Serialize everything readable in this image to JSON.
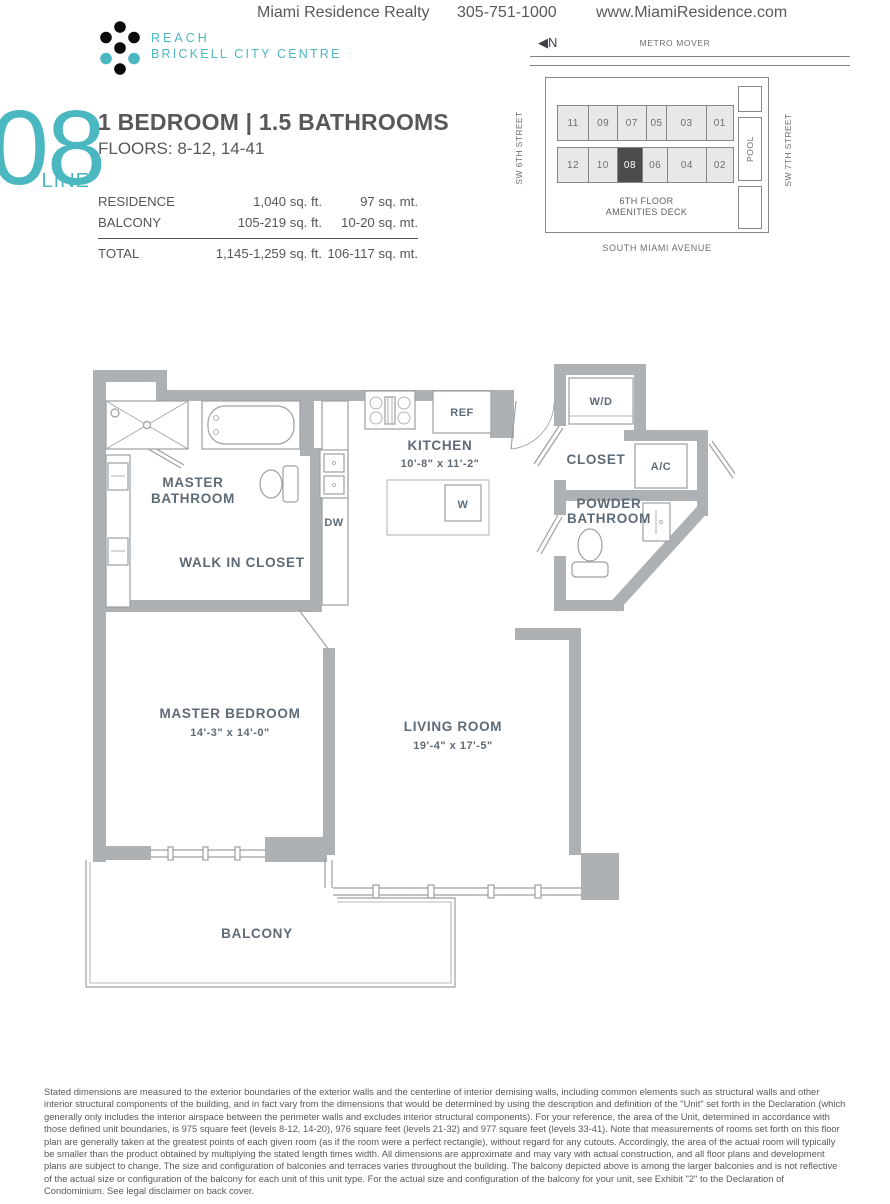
{
  "header": {
    "realty": "Miami Residence Realty",
    "phone": "305-751-1000",
    "website": "www.MiamiResidence.com"
  },
  "logo": {
    "name": "REACH",
    "subname": "BRICKELL CITY CENTRE"
  },
  "unit": {
    "line_number": "08",
    "line_label": "LINE",
    "title": "1 BEDROOM | 1.5 BATHROOMS",
    "floors": "FLOORS: 8-12, 14-41"
  },
  "area_table": {
    "rows": [
      {
        "label": "RESIDENCE",
        "sqft": "1,040 sq. ft.",
        "sqmt": "97 sq. mt."
      },
      {
        "label": "BALCONY",
        "sqft": "105-219 sq. ft.",
        "sqmt": "10-20 sq. mt."
      }
    ],
    "total": {
      "label": "TOTAL",
      "sqft": "1,145-1,259 sq. ft.",
      "sqmt": "106-117 sq. mt."
    }
  },
  "keyplan": {
    "north_label": "N",
    "metro_mover": "METRO MOVER",
    "street_left": "SW 6TH STREET",
    "street_right": "SW 7TH STREET",
    "pool": "POOL",
    "amenities_line1": "6TH  FLOOR",
    "amenities_line2": "AMENITIES DECK",
    "street_bottom": "SOUTH MIAMI AVENUE",
    "top_units": [
      "11",
      "09",
      "07",
      "05",
      "03",
      "01"
    ],
    "bottom_units": [
      "12",
      "10",
      "08",
      "06",
      "04",
      "02"
    ],
    "highlighted_unit": "08"
  },
  "floorplan": {
    "master_bathroom": {
      "line1": "MASTER",
      "line2": "BATHROOM"
    },
    "walk_in_closet": "WALK IN CLOSET",
    "kitchen": {
      "name": "KITCHEN",
      "dims": "10'-8\" x 11'-2\""
    },
    "wd": "W/D",
    "closet": "CLOSET",
    "ac": "A/C",
    "powder_bathroom": {
      "line1": "POWDER",
      "line2": "BATHROOM"
    },
    "dw": "DW",
    "ref": "REF",
    "w": "W",
    "master_bedroom": {
      "name": "MASTER BEDROOM",
      "dims": "14'-3\" x 14'-0\""
    },
    "living_room": {
      "name": "LIVING ROOM",
      "dims": "19'-4\" x 17'-5\""
    },
    "balcony": "BALCONY"
  },
  "disclaimer": "Stated dimensions are measured to the exterior boundaries of the exterior walls and the centerline of interior demising walls, including common elements such as structural walls and other interior structural components of the building, and in fact vary from the dimensions that would be determined by using the description and definition of the \"Unit\"  set forth in the Declaration (which generally only includes the interior airspace between the perimeter walls and excludes interior structural components). For your reference, the area of the Unit, determined in accordance with those defined unit boundaries, is 975 square feet (levels 8-12, 14-20), 976 square feet (levels 21-32) and 977 square feet (levels 33-41). Note that measurements of rooms set forth on this floor plan are generally taken at the greatest points of each given room (as if the room were a perfect rectangle), without regard for any cutouts. Accordingly, the area of the actual room will typically be smaller than the product obtained by multiplying the stated length times width. All dimensions are approximate and may vary with actual construction, and all floor plans and development plans are subject to change. The size and configuration of balconies and terraces varies throughout the building.  The balcony depicted above is among the larger balconies and is not reflective of the actual size or configuration of the balcony for each unit of this unit type. For the actual size and configuration of the balcony for your unit, see Exhibit \"2\" to the Declaration of Condominium. See legal disclaimer on back cover.",
  "colors": {
    "teal": "#4bb8c1",
    "highlight_unit": "#4b4c4e",
    "wall_gray": "#aeb1b4"
  }
}
